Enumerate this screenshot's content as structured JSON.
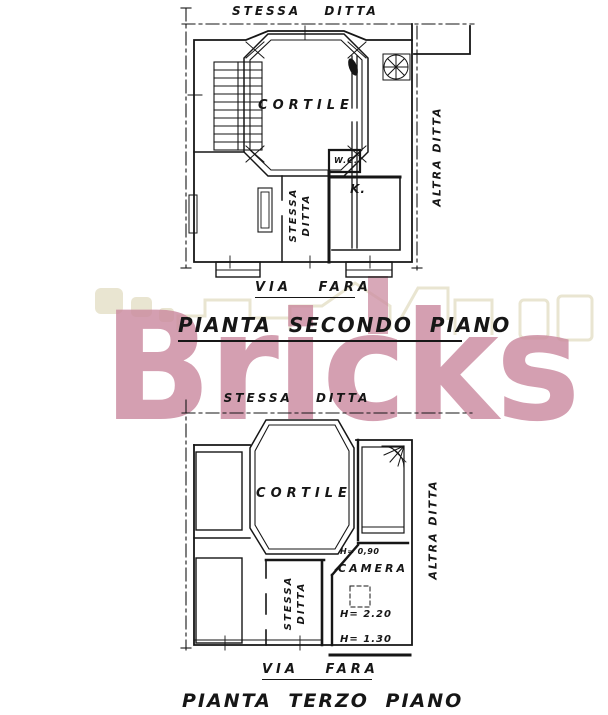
{
  "watermark": {
    "logo_text": "Bricks",
    "pink": "#cb8ba0",
    "beige": "#e9e5d1"
  },
  "plan_secondo": {
    "boundary_top_label": "STESSA DITTA",
    "boundary_right_label": "ALTRA DITTA",
    "courtyard_label": "CORTILE",
    "wc_label": "W.C.",
    "kitchen_label": "K.",
    "vertical_label_line1": "STESSA",
    "vertical_label_line2": "DITTA",
    "street_label": "VIA FARA",
    "caption": "PIANTA SECONDO PIANO"
  },
  "plan_terzo": {
    "boundary_top_label": "STESSA DITTA",
    "boundary_right_label": "ALTRA DITTA",
    "courtyard_label": "CORTILE",
    "room_label": "CAMERA",
    "height_door": "H= 0,90",
    "height_ceiling": "H= 2.20",
    "height_low": "H= 1.30",
    "vertical_label_line1": "STESSA",
    "vertical_label_line2": "DITTA",
    "street_label": "VIA FARA",
    "caption": "PIANTA TERZO PIANO"
  }
}
